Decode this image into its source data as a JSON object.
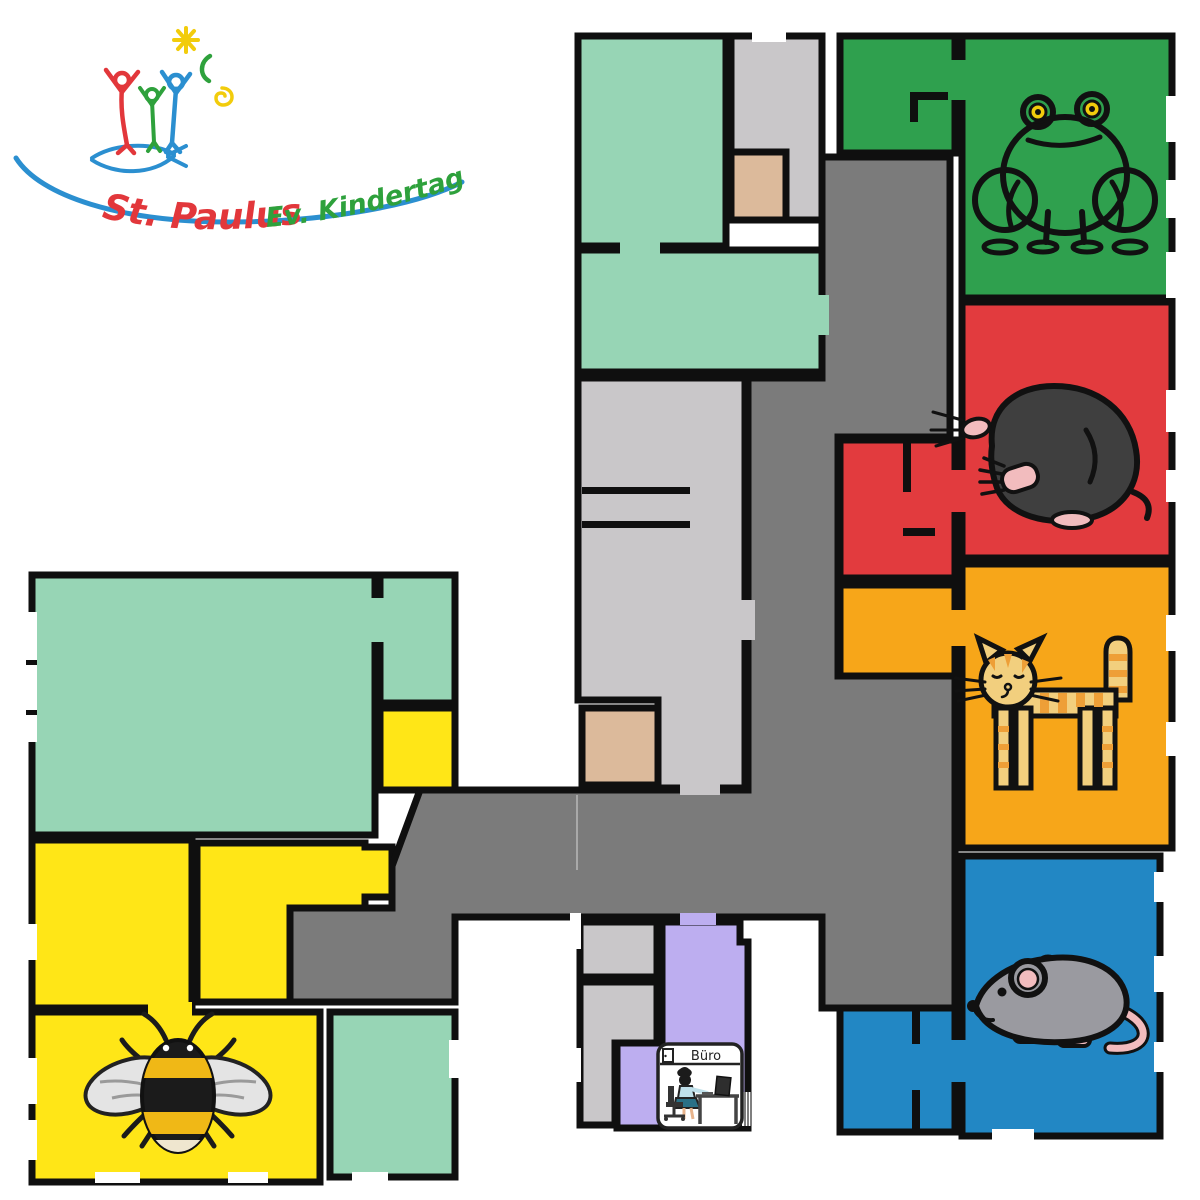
{
  "logo": {
    "line1": "St. Paulus",
    "line2": "Ev. Kindertagesstätte"
  },
  "floorplan": {
    "office_label": "Büro",
    "rooms": [
      {
        "id": "frog-room",
        "icon": "frog-icon",
        "color_key": "group_green"
      },
      {
        "id": "mole-room",
        "icon": "mole-icon",
        "color_key": "group_red"
      },
      {
        "id": "cat-room",
        "icon": "cat-icon",
        "color_key": "group_orange"
      },
      {
        "id": "mouse-room",
        "icon": "mouse-icon",
        "color_key": "group_blue"
      },
      {
        "id": "bee-room",
        "icon": "bee-icon",
        "color_key": "group_yellow"
      },
      {
        "id": "office",
        "icon": "office-desk-icon",
        "color_key": "lavender",
        "label": "Büro"
      }
    ]
  },
  "colors": {
    "mint": "#97d5b5",
    "light_gray": "#c9c7c9",
    "corridor_gray": "#7b7b7b",
    "tan": "#dcba9b",
    "group_green": "#2fa04e",
    "frog_body": "#68b52d",
    "group_red": "#e23b3e",
    "group_orange": "#f7a619",
    "cat_body": "#f2cf7e",
    "cat_stripe": "#ee9f37",
    "group_blue": "#2287c4",
    "mouse_body": "#9a9aa0",
    "pink": "#f2bcbe",
    "group_yellow": "#ffe617",
    "lavender": "#bdaef0",
    "wall": "#0f0f0f",
    "logo_red": "#e2373b",
    "logo_green": "#2ea13c",
    "logo_blue": "#2b8fd0",
    "logo_yellow": "#f2cc0c"
  }
}
